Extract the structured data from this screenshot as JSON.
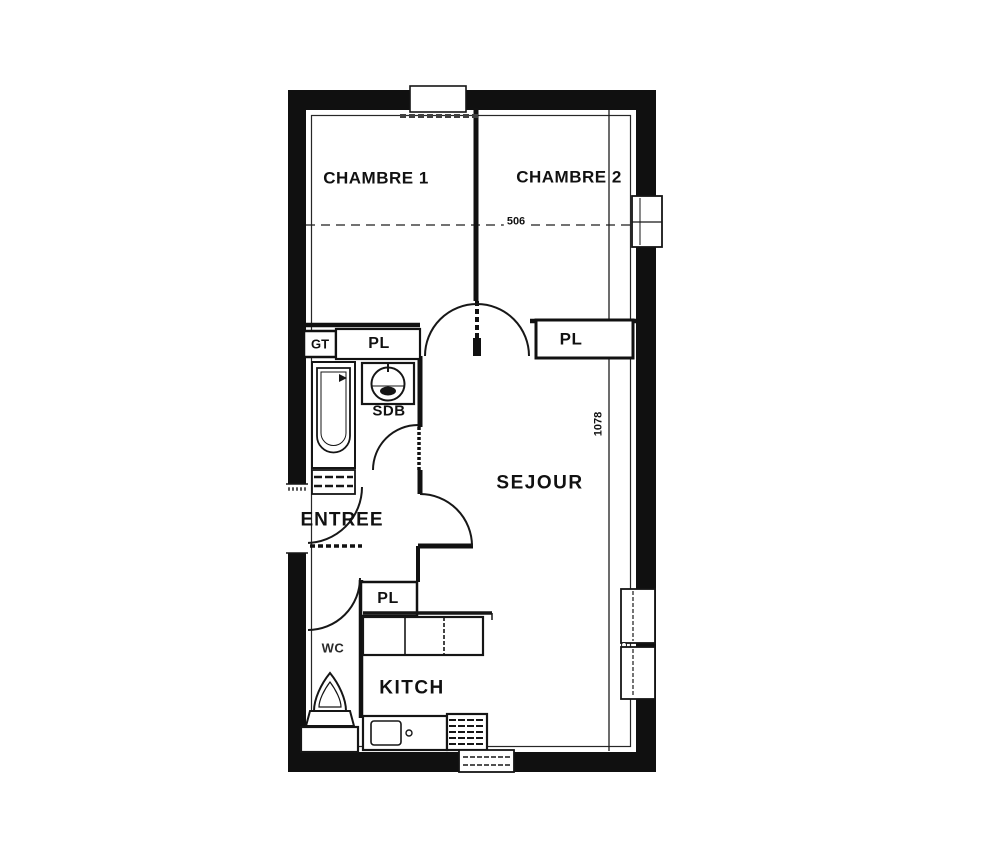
{
  "plan": {
    "type": "apartment-floor-plan",
    "labels": {
      "chambre1": "CHAMBRE 1",
      "chambre2": "CHAMBRE 2",
      "sejour": "SEJOUR",
      "entree": "ENTREE",
      "kitchen": "KITCH",
      "wc": "WC",
      "bathroom": "SDB",
      "closet_bathroom": "PL",
      "closet_sejour": "PL",
      "closet_kitchen": "PL",
      "duct": "GT"
    },
    "dimensions": {
      "width": "506",
      "depth": "1078"
    },
    "fixtures": [
      "bathtub",
      "washbasin",
      "toilet",
      "kitchen-sink",
      "cooker",
      "kitchen-counter",
      "wc-cabinet"
    ],
    "colors": {
      "line": "#1a1a1a",
      "background": "#ffffff"
    }
  }
}
